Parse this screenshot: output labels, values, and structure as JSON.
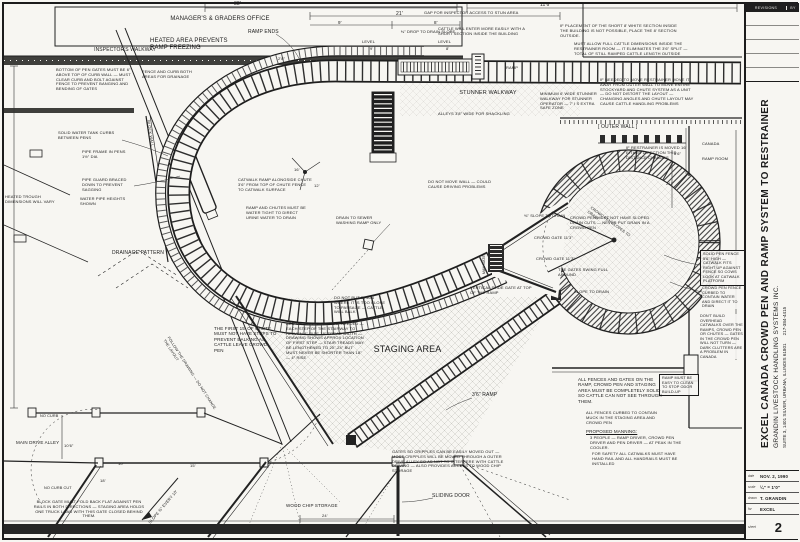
{
  "sheet": {
    "background": "#f7f6f2",
    "ink": "#1c1c1c"
  },
  "title_block": {
    "revisions_label": "REVISIONS",
    "by_label": "BY",
    "project_title": "EXCEL CANADA CROWD PEN AND RAMP SYSTEM TO RESTRAINER",
    "firm": "GRANDIN LIVESTOCK HANDLING SYSTEMS INC.",
    "address": "SUITE 3, 1401 SILVER, URBANA, ILLINOIS 61801",
    "phone": "217-384-4415",
    "fields": [
      {
        "label": "date",
        "value": "NOV. 2, 1990"
      },
      {
        "label": "scale",
        "value": "¼\" = 1'0\""
      },
      {
        "label": "drawn",
        "value": "T. GRANDIN"
      },
      {
        "label": "for",
        "value": "EXCEL"
      },
      {
        "label": "sheet",
        "value": "2"
      }
    ]
  },
  "annotations": [
    {
      "name": "office-label",
      "text": "MANAGER'S & GRADERS OFFICE",
      "x": 150,
      "y": 16,
      "w": 140,
      "fs": 6,
      "ta": "center"
    },
    {
      "name": "inspectors-walkway-label",
      "text": "INSPECTOR'S WALKWAY",
      "x": 70,
      "y": 47,
      "w": 110,
      "fs": 5,
      "ta": "center"
    },
    {
      "text": "BOTTOM OF PEN GATES MUST BE 6\" ABOVE TOP OF CURB WALL — MUST CLEAR CURB AND BOLT AGAINST FENCE TO PREVENT BANGING AND BENDING OF GATES",
      "x": 56,
      "y": 68,
      "w": 80,
      "fs": 4
    },
    {
      "text": "FENCE AND CURB BOTH AREAS FOR DRAINAGE",
      "x": 142,
      "y": 70,
      "w": 56,
      "fs": 4
    },
    {
      "name": "heated-area-note",
      "text": "HEATED AREA PREVENTS RAMP FREEZING",
      "x": 150,
      "y": 38,
      "w": 92,
      "fs": 6
    },
    {
      "name": "ramp-ends-label",
      "text": "RAMP ENDS",
      "x": 248,
      "y": 29,
      "w": 50,
      "fs": 5
    },
    {
      "name": "dimension-label",
      "text": "38'",
      "x": 234,
      "y": 1,
      "w": 20,
      "fs": 5
    },
    {
      "name": "dimension-label",
      "text": "21'",
      "x": 396,
      "y": 11,
      "w": 18,
      "fs": 5
    },
    {
      "name": "dimension-label",
      "text": "9'",
      "x": 338,
      "y": 20,
      "w": 14,
      "fs": 4.5
    },
    {
      "name": "dimension-label",
      "text": "8'",
      "x": 434,
      "y": 20,
      "w": 14,
      "fs": 4.5
    },
    {
      "name": "dimension-label",
      "text": "11'6\"",
      "x": 540,
      "y": 2,
      "w": 26,
      "fs": 5
    },
    {
      "text": "⅜\" DROP TO DRAIN SLOPE",
      "x": 368,
      "y": 30,
      "w": 120,
      "fs": 4,
      "ta": "center"
    },
    {
      "text": "LEVEL",
      "x": 362,
      "y": 40,
      "w": 22,
      "fs": 4
    },
    {
      "name": "dimension-label",
      "text": "9'",
      "x": 370,
      "y": 47,
      "w": 12,
      "fs": 4
    },
    {
      "text": "LEVEL",
      "x": 438,
      "y": 40,
      "w": 22,
      "fs": 4
    },
    {
      "name": "dimension-label",
      "text": "8'",
      "x": 446,
      "y": 47,
      "w": 12,
      "fs": 4
    },
    {
      "name": "ramp-label",
      "text": "RAMP",
      "x": 506,
      "y": 66,
      "w": 28,
      "fs": 4
    },
    {
      "name": "dimension-label",
      "text": "2'8\"",
      "x": 278,
      "y": 57,
      "w": 20,
      "fs": 4
    },
    {
      "text": "GAP FOR INSPECTOR ACCESS TO STUN AREA",
      "x": 424,
      "y": 11,
      "w": 100,
      "fs": 4
    },
    {
      "text": "CATTLE WILL ENTER MORE EASILY WITH A SHORT SECTION INSIDE THE BUILDING",
      "x": 438,
      "y": 27,
      "w": 92,
      "fs": 4
    },
    {
      "text": "IF PLACEMENT OF THE SHORT 8' WHITE SECTION INSIDE THE BUILDING IS NOT POSSIBLE, PLACE THE 8' SECTION OUTSIDE.",
      "x": 560,
      "y": 24,
      "w": 120,
      "fs": 4
    },
    {
      "text": "MUST ALLOW FULL CATTLE DIMENSIONS INSIDE THE RESTRAINER ROOM — IT ELIMINATES THE 3'6\" SPLIT — TOTAL OF STILL RAMPED CATTLE LENGTH OUTSIDE",
      "x": 574,
      "y": 42,
      "w": 118,
      "fs": 4
    },
    {
      "name": "stunner-walkway-label",
      "text": "STUNNER WALKWAY",
      "x": 436,
      "y": 90,
      "w": 104,
      "fs": 5.5,
      "ta": "center"
    },
    {
      "text": "MINIMUM 6' WIDE STUNNER WALKWAY FOR STUNNER OPERATOR — 7' I S EXTRA SAFE ZONE",
      "x": 540,
      "y": 92,
      "w": 60,
      "fs": 4
    },
    {
      "text": "ALLEYS 3'8\" WIDE FOR SHACKLING",
      "x": 438,
      "y": 112,
      "w": 140,
      "fs": 4
    },
    {
      "text": "IF NEEDED TO MOVE RESTRAINER MOVE IT AWAY FROM OUTER WALL TO MOVE ENTIRE STOCKYARD AND CHUTE SYSTEM AS A UNIT — DO NOT DISTORT THE LAYOUT — CHANGING ANGLES AND CHUTE LAYOUT MAY CAUSE CATTLE HANDLING PROBLEMS",
      "x": 600,
      "y": 78,
      "w": 95,
      "fs": 4
    },
    {
      "name": "outer-wall-label",
      "text": "[ OUTER WALL ]",
      "x": 598,
      "y": 124,
      "w": 64,
      "fs": 5
    },
    {
      "text": "IF RESTRAINER IS MOVED 16' EITHER DIRECTION THIS DISTANCE CHANGES",
      "x": 626,
      "y": 146,
      "w": 72,
      "fs": 4
    },
    {
      "name": "dimension-label",
      "text": "8'6\"",
      "x": 674,
      "y": 152,
      "w": 20,
      "fs": 4
    },
    {
      "name": "canada-label",
      "text": "CANADA",
      "x": 702,
      "y": 142,
      "w": 40,
      "fs": 4
    },
    {
      "name": "ramp-room-label",
      "text": "RAMP ROOM",
      "x": 702,
      "y": 157,
      "w": 44,
      "fs": 4
    },
    {
      "name": "dimension-label",
      "text": "21'",
      "x": 666,
      "y": 182,
      "w": 16,
      "fs": 4
    },
    {
      "text": "SOLID WATER TANK CURBS BETWEEN PENS",
      "x": 58,
      "y": 131,
      "w": 64,
      "fs": 4
    },
    {
      "text": "PIPE FRAME IN PENS 1½\" DIA",
      "x": 82,
      "y": 150,
      "w": 48,
      "fs": 4
    },
    {
      "text": "PIPE GUARD BRACED DOWN TO PREVENT SAGGING",
      "x": 82,
      "y": 178,
      "w": 54,
      "fs": 4
    },
    {
      "text": "WATER PIPE HEIGHTS SHOWN",
      "x": 80,
      "y": 197,
      "w": 50,
      "fs": 4
    },
    {
      "text": "HEATED TROUGH DIMENSIONS WILL VARY",
      "x": 5,
      "y": 195,
      "w": 54,
      "fs": 4
    },
    {
      "name": "block-wall-label",
      "text": "BLOCK WALL",
      "x": 150,
      "y": 120,
      "w": 40,
      "fs": 4,
      "rot": 81
    },
    {
      "name": "drainage-pattern-label",
      "text": "DRAINAGE PATTERN",
      "x": 112,
      "y": 250,
      "w": 74,
      "fs": 5
    },
    {
      "text": "CATWALK RAMP ALONGSIDE CHUTE 3'6\" FROM TOP OF CHUTE FENCE TO CATWALK SURFACE",
      "x": 238,
      "y": 178,
      "w": 74,
      "fs": 4
    },
    {
      "text": "RAMP AND CHUTES MUST BE WATER TIGHT TO DIRECT URINE WATER TO DRAIN",
      "x": 246,
      "y": 206,
      "w": 64,
      "fs": 4
    },
    {
      "text": "DRAIN TO SEWER WASHING RAMP ONLY",
      "x": 336,
      "y": 216,
      "w": 54,
      "fs": 4
    },
    {
      "name": "dimension-label",
      "text": "16'",
      "x": 294,
      "y": 168,
      "w": 16,
      "fs": 4
    },
    {
      "name": "dimension-label",
      "text": "12'",
      "x": 314,
      "y": 184,
      "w": 16,
      "fs": 4
    },
    {
      "text": "THE FIRST 15' OF CHUTE MUST NOT HAVE STEPS TO PREVENT BALKING AS CATTLE LEAVE CROWD PEN",
      "x": 214,
      "y": 326,
      "w": 64,
      "fs": 4.5
    },
    {
      "text": "ADD OR DELETE STEPS IF NEEDED — EACH STEP OF THE STAIRWAY TO HEAVEN 4\" RISE 18\" TREAD WIDTH — DRAWING SHOWS APPROX LOCATION OF FIRST STEP — STAIR TREADS MAY BE LENGTHENED TO 20\"-24\" BUT MUST NEVER BE SHORTER THAN 18\" — 4\" RISE",
      "x": 286,
      "y": 322,
      "w": 78,
      "fs": 4
    },
    {
      "text": "DO NOT PUT DRAIN WHERE IT IS TOO CLOSE TO PASSAGE — CATTLE WILL BALK",
      "x": 334,
      "y": 296,
      "w": 56,
      "fs": 4
    },
    {
      "name": "staging-area-label",
      "text": "STAGING AREA",
      "x": 350,
      "y": 344,
      "w": 115,
      "fs": 9,
      "ta": "center"
    },
    {
      "name": "ramp-36-label",
      "text": "3'6\" RAMP",
      "x": 472,
      "y": 392,
      "w": 48,
      "fs": 5
    },
    {
      "text": "VERTICAL SLIDE GATE AT TOP OF THE RAMP",
      "x": 470,
      "y": 286,
      "w": 62,
      "fs": 4
    },
    {
      "text": "DO NOT MOVE WALL — COULD CAUSE DRIVING PROBLEMS",
      "x": 428,
      "y": 180,
      "w": 74,
      "fs": 4
    },
    {
      "text": "⅜\" SLOPE TO DRAIN",
      "x": 524,
      "y": 214,
      "w": 44,
      "fs": 4
    },
    {
      "text": "CROWD PEN MUST NOT HAVE SLOPED DRAIN CUTS — NEVER PUT DRAIN IN A CROWD PEN",
      "x": 570,
      "y": 216,
      "w": 82,
      "fs": 4
    },
    {
      "name": "crowd-gate-label",
      "text": "CROWD GATE 11'3\"",
      "x": 534,
      "y": 236,
      "w": 58,
      "fs": 4
    },
    {
      "name": "crowd-gate-label",
      "text": "CROWD GATE 11'3\"",
      "x": 536,
      "y": 257,
      "w": 58,
      "fs": 4
    },
    {
      "name": "man-gate-label",
      "text": "MAN GATE",
      "x": 482,
      "y": 274,
      "w": 30,
      "fs": 3.5,
      "rot": -90
    },
    {
      "text": "THE GATES SWING FULL AROUND",
      "x": 558,
      "y": 268,
      "w": 56,
      "fs": 4
    },
    {
      "text": "SLOPE TO DRAIN",
      "x": 574,
      "y": 290,
      "w": 50,
      "fs": 4
    },
    {
      "text": "SOLID PEN FENCE 5'6\" HIGH — CATWALK FITS RIGHT UP AGAINST FENCE SO COWS LOOK AT CATWALK PLATFORM",
      "x": 700,
      "y": 250,
      "w": 40,
      "fs": 3.8,
      "box": true,
      "bg": true
    },
    {
      "text": "CROWD PEN FENCE CURBED TO CONTAIN WATER AND DIRECT IT TO DRAIN",
      "x": 702,
      "y": 286,
      "w": 40,
      "fs": 3.8,
      "bg": true
    },
    {
      "text": "DON'T BUILD OVERHEAD CATWALKS OVER THE RAMPS, CROWD PEN OR CHUTES — GATES IN THE CROWD PEN WILL NOT TURN — DARK CLUTTERS ARE A PROBLEM IN CANADA",
      "x": 700,
      "y": 314,
      "w": 44,
      "fs": 3.8,
      "bg": true
    },
    {
      "text": "RAMP MUST BE EASY TO CLEAN TO STOP ODOR BUILD-UP",
      "x": 659,
      "y": 374,
      "w": 34,
      "fs": 3.8,
      "box": true,
      "bg": true
    },
    {
      "text": "ALL FENCES AND GATES ON THE RAMP, CROWD PEN AND STAGING AREA MUST BE COMPLETELY SOLID SO CATTLE CAN NOT SEE THROUGH THEM.",
      "x": 578,
      "y": 377,
      "w": 84,
      "fs": 4.5
    },
    {
      "text": "ALL FENCES CURBED TO CONTAIN MUCK IN THE STAGING AREA AND CROWD PEN",
      "x": 586,
      "y": 411,
      "w": 84,
      "fs": 4
    },
    {
      "text": "PROPOSED MANNING:",
      "x": 586,
      "y": 429,
      "w": 66,
      "fs": 4.5,
      "u": true
    },
    {
      "text": "3 PEOPLE — RAMP DRIVER, CROWD PEN DRIVER AND PEN DRIVER — AT PEAK IN THE COOLER.",
      "x": 590,
      "y": 436,
      "w": 92,
      "fs": 4
    },
    {
      "text": "FOR SAFETY ALL CATWALKS MUST HAVE HAND RAIL AND ALL HANDRAILS MUST BE INSTALLED",
      "x": 592,
      "y": 452,
      "w": 90,
      "fs": 4
    },
    {
      "text": "GATES SO CRIPPLES CAN BE EASILY MOVED OUT — MOST CRIPPLES WILL BE MOVED THROUGH A OUTER DRIVE ALLEY SO AS NOT TO INTERFERE WITH CATTLE DRIVING — ALSO PROVIDES ACCESS TO WOOD CHIP STORAGE",
      "x": 392,
      "y": 450,
      "w": 112,
      "fs": 4
    },
    {
      "name": "sliding-door-label",
      "text": "SLIDING DOOR",
      "x": 432,
      "y": 493,
      "w": 56,
      "fs": 5
    },
    {
      "name": "wood-chip-storage-label",
      "text": "WOOD CHIP STORAGE",
      "x": 286,
      "y": 503,
      "w": 76,
      "fs": 4.5
    },
    {
      "name": "dimension-label",
      "text": "24'",
      "x": 322,
      "y": 514,
      "w": 18,
      "fs": 4
    },
    {
      "name": "main-drive-alley-label",
      "text": "MAIN DRIVE ALLEY",
      "x": 16,
      "y": 440,
      "w": 48,
      "fs": 4.5
    },
    {
      "text": "NO CURB",
      "x": 40,
      "y": 414,
      "w": 32,
      "fs": 3.8
    },
    {
      "text": "NO CURB CUT",
      "x": 44,
      "y": 486,
      "w": 42,
      "fs": 3.8
    },
    {
      "name": "dimension-label",
      "text": "10'6\"",
      "x": 64,
      "y": 444,
      "w": 22,
      "fs": 4
    },
    {
      "text": "BLOCK GATE MUST FOLD BACK FLAT AGAINST PEN RAILS IN BOTH DIRECTIONS — STAGING AREA HOLDS ONE TRUCK LOAD WITH THIS GATE CLOSED BEHIND THEM.",
      "x": 30,
      "y": 500,
      "w": 118,
      "fs": 4,
      "ta": "center"
    },
    {
      "text": "SLOPE ⅜\" EVERY 10'",
      "x": 148,
      "y": 522,
      "w": 62,
      "fs": 4,
      "rot": -50
    },
    {
      "name": "dimension-label",
      "text": "15'",
      "x": 190,
      "y": 464,
      "w": 16,
      "fs": 4
    },
    {
      "name": "dimension-label",
      "text": "10'",
      "x": 118,
      "y": 462,
      "w": 16,
      "fs": 4
    },
    {
      "name": "dimension-label",
      "text": "18'",
      "x": 100,
      "y": 479,
      "w": 16,
      "fs": 4
    },
    {
      "text": "FOLLOW THE DRAWING — DO NOT CHANGE THE LAYOUT",
      "x": 170,
      "y": 336,
      "w": 90,
      "fs": 3.8,
      "rot": 57
    },
    {
      "text": "CROWD PEN SLOPES TO DRAIN",
      "x": 592,
      "y": 206,
      "w": 60,
      "fs": 3.8,
      "rot": 36
    }
  ]
}
